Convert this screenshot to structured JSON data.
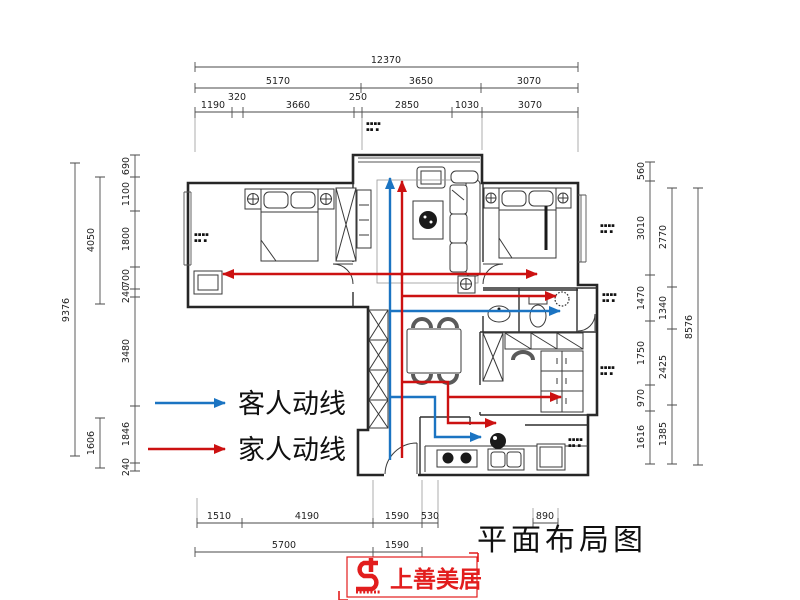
{
  "title": "平面布局图",
  "legend": {
    "guest": {
      "label": "客人动线"
    },
    "family": {
      "label": "家人动线"
    }
  },
  "colors": {
    "guest_line": "#1b74c2",
    "family_line": "#cc1111",
    "logo_red": "#e21d1d"
  },
  "logo": {
    "name": "上善美居"
  },
  "dims": {
    "top": {
      "total": "12370",
      "row2": [
        "5170",
        "3650",
        "3070"
      ],
      "row3": [
        "1190",
        "320",
        "3660",
        "250",
        "2850",
        "1030",
        "3070"
      ]
    },
    "left": {
      "total": "9376",
      "mid": [
        "4050",
        "1606"
      ],
      "inner": [
        "690",
        "1100",
        "1800",
        "700",
        "240",
        "3480",
        "1846",
        "240"
      ]
    },
    "right": {
      "total": "8576",
      "mid": [
        "2770",
        "1340",
        "2425",
        "1385"
      ],
      "inner": [
        "560",
        "3010",
        "1470",
        "1750",
        "970",
        "1616"
      ]
    },
    "bottom": {
      "row1": [
        "1510",
        "4190",
        "1590",
        "530"
      ],
      "offset": "890",
      "row2": [
        "5700",
        "1590"
      ]
    }
  },
  "annotation": {
    "line1": "▪▪▪▪",
    "line2": "▪▪ ▪"
  }
}
